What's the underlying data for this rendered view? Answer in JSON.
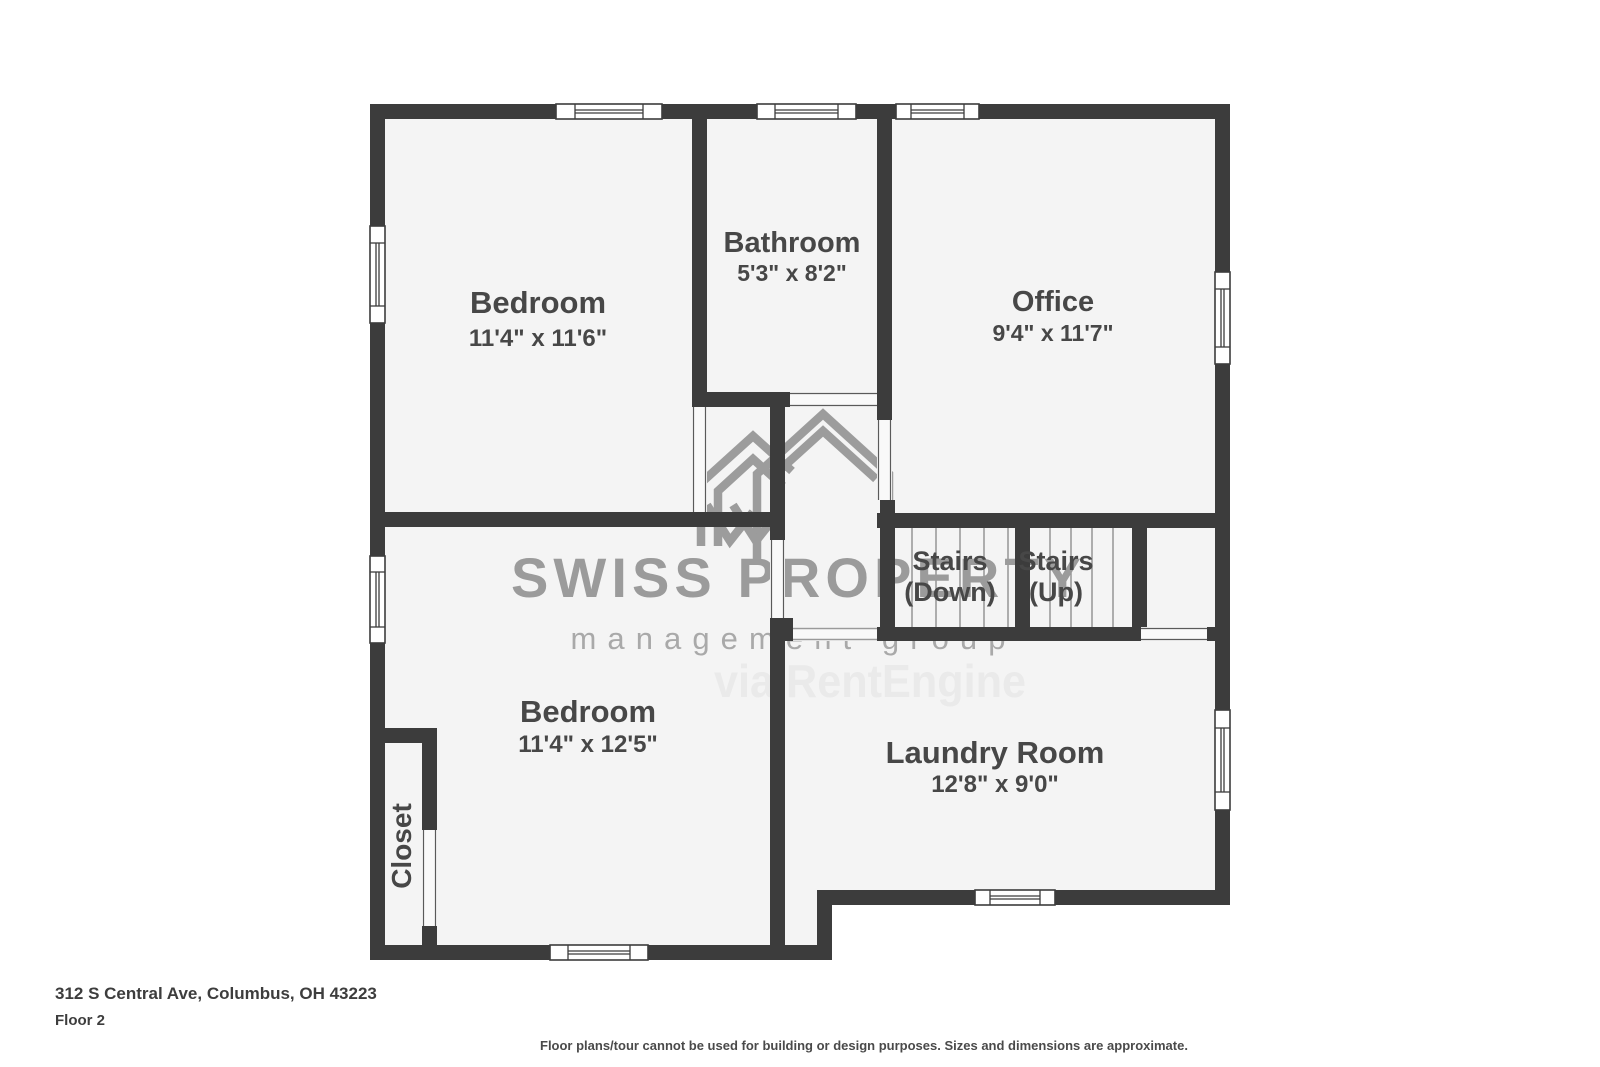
{
  "rooms": {
    "bedroom_top": {
      "label": "Bedroom",
      "dims": "11'4\" x 11'6\""
    },
    "bathroom": {
      "label": "Bathroom",
      "dims": "5'3\" x 8'2\""
    },
    "office": {
      "label": "Office",
      "dims": "9'4\" x 11'7\""
    },
    "stairs_down": {
      "label": "Stairs",
      "sub": "(Down)"
    },
    "stairs_up": {
      "label": "Stairs",
      "sub": "(Up)"
    },
    "bedroom_bottom": {
      "label": "Bedroom",
      "dims": "11'4\" x 12'5\""
    },
    "laundry": {
      "label": "Laundry Room",
      "dims": "12'8\" x 9'0\""
    },
    "closet": {
      "label": "Closet"
    }
  },
  "watermark": {
    "logo_icon": "house-outline-icon",
    "brand": "SWISS PROPERTY",
    "tagline": "management group",
    "via": "via RentEngine"
  },
  "footer": {
    "address": "312 S Central Ave, Columbus, OH 43223",
    "floor_label": "Floor 2",
    "disclaimer": "Floor plans/tour cannot be used for building or design purposes. Sizes and dimensions are approximate."
  },
  "colors": {
    "wall": "#3c3c3c",
    "floor": "#f4f4f4",
    "room_label": "#474747",
    "watermark_gray": "#9b9b9b",
    "watermark_light": "#eaeaea"
  }
}
